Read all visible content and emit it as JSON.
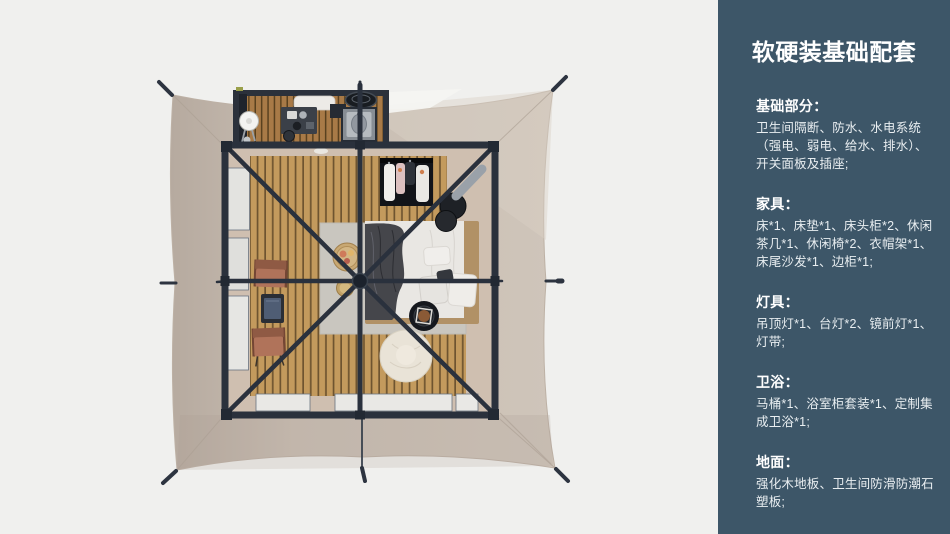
{
  "panel": {
    "title": "软硬装基础配套",
    "sections": [
      {
        "id": "basics",
        "heading": "基础部分：",
        "body": "卫生间隔断、防水、水电系统\n（强电、弱电、给水、排水）、\n开关面板及插座;"
      },
      {
        "id": "furniture",
        "heading": "家具：",
        "body": "床*1、床垫*1、床头柜*2、休闲\n茶几*1、休闲椅*2、衣帽架*1、\n床尾沙发*1、边柜*1;"
      },
      {
        "id": "lighting",
        "heading": "灯具：",
        "body": "吊顶灯*1、台灯*2、镜前灯*1、\n灯带;"
      },
      {
        "id": "bathroom",
        "heading": "卫浴：",
        "body": "马桶*1、浴室柜套装*1、定制集\n成卫浴*1;"
      },
      {
        "id": "flooring",
        "heading": "地面：",
        "body": "强化木地板、卫生间防滑防潮石\n塑板;"
      }
    ]
  },
  "floorplan": {
    "view": "top-down-render",
    "items": [
      "tent-canopy",
      "guy-line-stakes",
      "center-mast",
      "frame-poles",
      "bathroom-block",
      "vanity-mirror",
      "vanity-unit",
      "washstand",
      "standing-fan",
      "bath-tub",
      "bed",
      "mattress-duvet",
      "throw-blanket",
      "pillows",
      "headboard",
      "clothes-rack",
      "stool-side-tables",
      "round-side-table",
      "bean-bag",
      "lounge-chair-1",
      "lounge-chair-2",
      "tea-table",
      "serving-trays",
      "rug",
      "wood-plank-floor",
      "window-panels",
      "door-mats"
    ],
    "colors": {
      "page_bg": "#f0f0ee",
      "panel_bg": "#3d5668",
      "panel_text": "#ffffff",
      "canopy": "#c7bcb1",
      "canopy_shadow": "#b6aa9f",
      "frame": "#2a313d",
      "wood_floor": "#c39a5d",
      "bathroom_floor": "#a87a47",
      "interior_border": "#cfbfb0",
      "rug": "#c9c6bf",
      "bed_duvet": "#e9e7e3",
      "throw_blanket": "#45464b",
      "headboard": "#b19166",
      "chair": "#b0735a",
      "bean_bag": "#e9e3d7"
    }
  }
}
